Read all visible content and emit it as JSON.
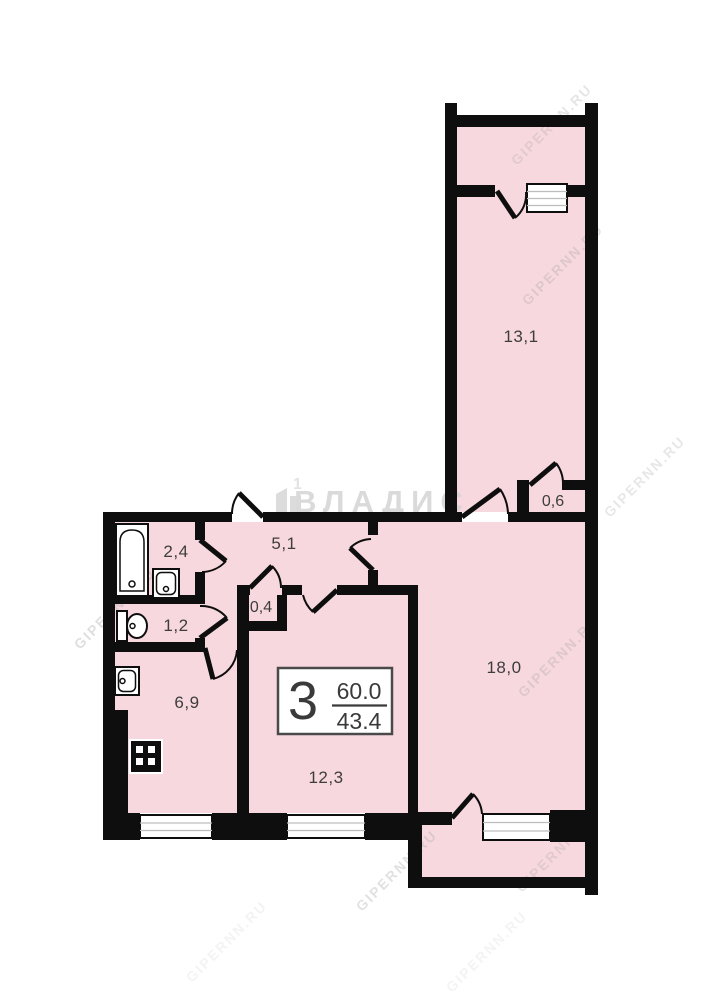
{
  "plan": {
    "type": "apartment-floor-plan",
    "apartment": {
      "rooms_count": "3",
      "total_area": "60.0",
      "living_area": "43.4"
    },
    "rooms": [
      {
        "name": "loggia-top-room",
        "area_label": "13,1"
      },
      {
        "name": "closet-top",
        "area_label": "0,6"
      },
      {
        "name": "bathroom",
        "area_label": "2,4"
      },
      {
        "name": "hallway",
        "area_label": "5,1"
      },
      {
        "name": "closet-small",
        "area_label": "0,4"
      },
      {
        "name": "wc",
        "area_label": "1,2"
      },
      {
        "name": "kitchen",
        "area_label": "6,9"
      },
      {
        "name": "living-room",
        "area_label": "18,0"
      },
      {
        "name": "bedroom",
        "area_label": "12,3"
      }
    ],
    "watermark": {
      "brand": "ВЛАДИС",
      "site": "GIPERNN.RU"
    },
    "colors": {
      "room_fill": "#f8d8df",
      "wall": "#0e0e0e",
      "label": "#3d3d3d",
      "watermark": "#c9c9c9"
    }
  }
}
